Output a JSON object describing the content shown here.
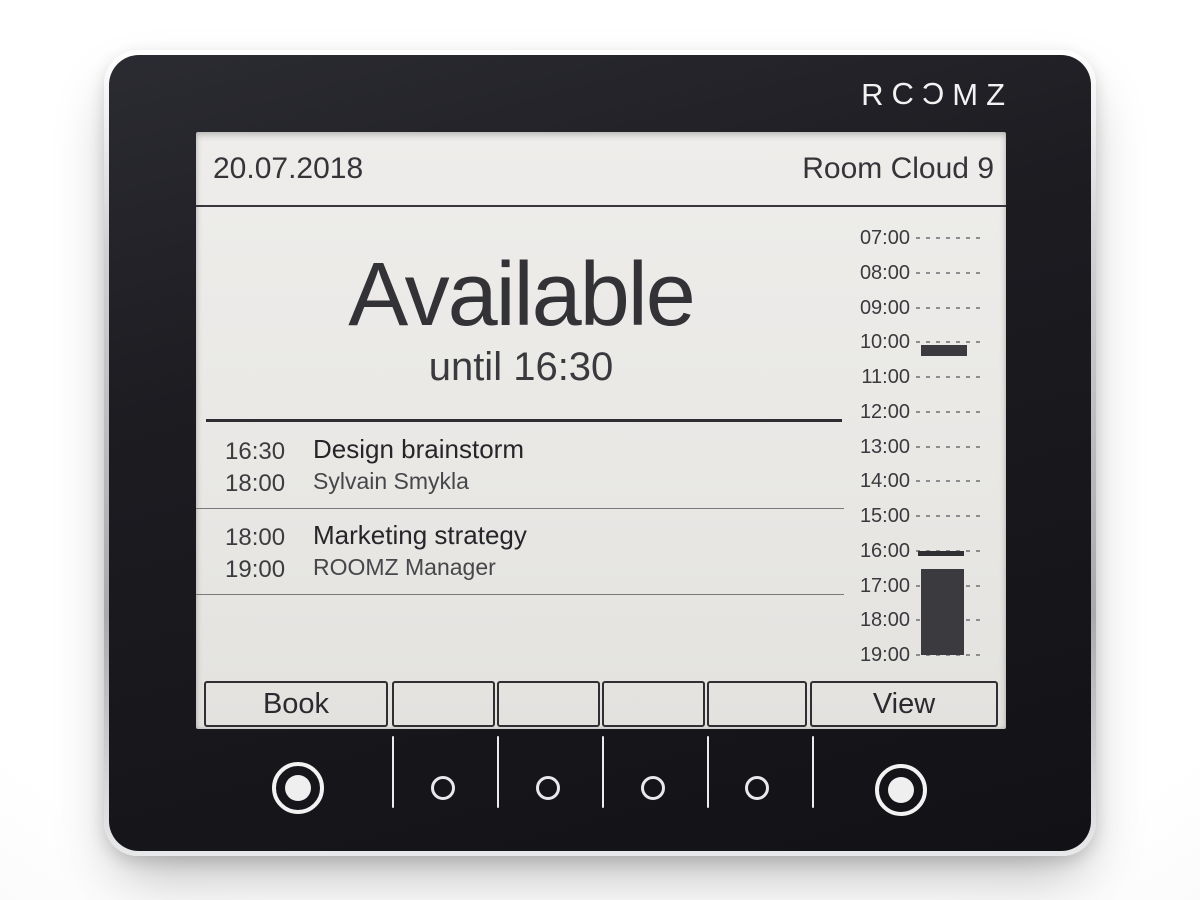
{
  "brand": {
    "name": "ROOMZ",
    "logo_letters": [
      "R",
      "C",
      "C",
      "M",
      "Z"
    ]
  },
  "colors": {
    "bezel": "#1c1c21",
    "screen": "#e9e8e5",
    "ink": "#2e2e32",
    "busy_block": "#3a3a3f",
    "logo": "#f2f2f3"
  },
  "screen": {
    "header": {
      "date": "20.07.2018",
      "room_name": "Room Cloud 9"
    },
    "status": {
      "state": "Available",
      "until": "until 16:30"
    },
    "meetings": [
      {
        "start": "16:30",
        "end": "18:00",
        "title": "Design brainstorm",
        "organizer": "Sylvain Smykla"
      },
      {
        "start": "18:00",
        "end": "19:00",
        "title": "Marketing strategy",
        "organizer": "ROOMZ Manager"
      }
    ],
    "timeline": {
      "hours": [
        "07:00",
        "08:00",
        "09:00",
        "10:00",
        "11:00",
        "12:00",
        "13:00",
        "14:00",
        "15:00",
        "16:00",
        "17:00",
        "18:00",
        "19:00"
      ],
      "busy_blocks": [
        {
          "start": "10:00",
          "end": "10:20"
        },
        {
          "start": "16:30",
          "end": "19:00"
        }
      ],
      "now_marker": "16:00"
    },
    "softkeys": {
      "book": "Book",
      "view": "View"
    }
  },
  "bezel": {
    "large_button_count": 2,
    "small_button_count": 4
  }
}
